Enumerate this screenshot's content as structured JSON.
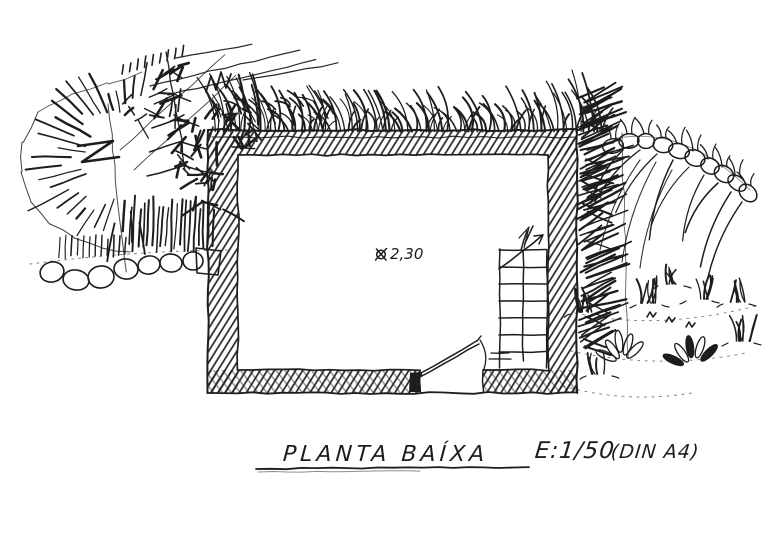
{
  "sketch": {
    "title": "PLANTA BAÍXA",
    "scale": "E:1/50",
    "paper": "(DIN A4)",
    "height_annotation": {
      "icon": "crossed-circle",
      "value": "2,30"
    },
    "colors": {
      "ink": "#1d1d1d",
      "paper": "#ffffff"
    }
  }
}
